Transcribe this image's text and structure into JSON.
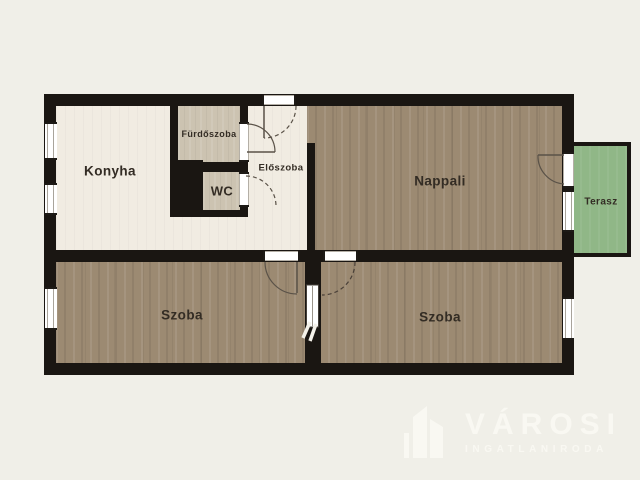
{
  "floorplan": {
    "rooms": {
      "konyha": "Konyha",
      "furdoszoba": "Fürdőszoba",
      "wc": "WC",
      "eloszoba": "Előszoba",
      "nappali": "Nappali",
      "terasz": "Terasz",
      "szoba_left": "Szoba",
      "szoba_right": "Szoba"
    },
    "colors": {
      "background": "#f0efe8",
      "wall": "#1a1612",
      "floor_light": "#f1ece2",
      "floor_tile": "#ccc3b1",
      "floor_wood": "#9c8a72",
      "terrace_green": "#90b787",
      "watermark": "#f9f8f2"
    },
    "icons": {
      "logo_icon": "building-skyline"
    }
  },
  "watermark": {
    "brand": "VÁROSI",
    "tagline": "INGATLANIRODA"
  }
}
